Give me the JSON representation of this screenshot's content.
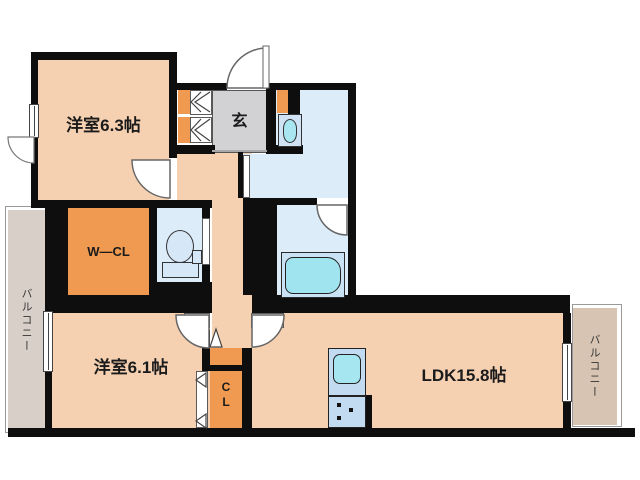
{
  "page": {
    "type": "apartment-floor-plan"
  },
  "rooms": {
    "bedroom_a": {
      "label": "洋室6.3帖"
    },
    "bedroom_b": {
      "label": "洋室6.1帖"
    },
    "ldk": {
      "label": "LDK15.8帖"
    },
    "entrance": {
      "label": "玄"
    },
    "walk_in_closet": {
      "label": "W―CL"
    },
    "closet": {
      "lines": [
        "C",
        "L"
      ]
    },
    "balcony_left": {
      "label": "バルコニー"
    },
    "balcony_right": {
      "label": "バルコニー"
    }
  },
  "colors": {
    "wall": "#0e0e0e",
    "room_fill": "#f5d1b2",
    "closet_fill": "#ef9a50",
    "entrance_fill": "#d2d2d4",
    "wet_room_fill": "#dcecf9",
    "fixture_water": "#a5e6f1",
    "balcony_left_fill": "#d8d0c8",
    "balcony_right_fill": "#d7c4b2"
  },
  "icons": [
    "toilet-icon",
    "washbasin-icon",
    "bathtub-icon",
    "kitchen-sink-icon",
    "stove-burners-icon",
    "door-swing-icon",
    "window-icon",
    "folding-door-icon"
  ]
}
